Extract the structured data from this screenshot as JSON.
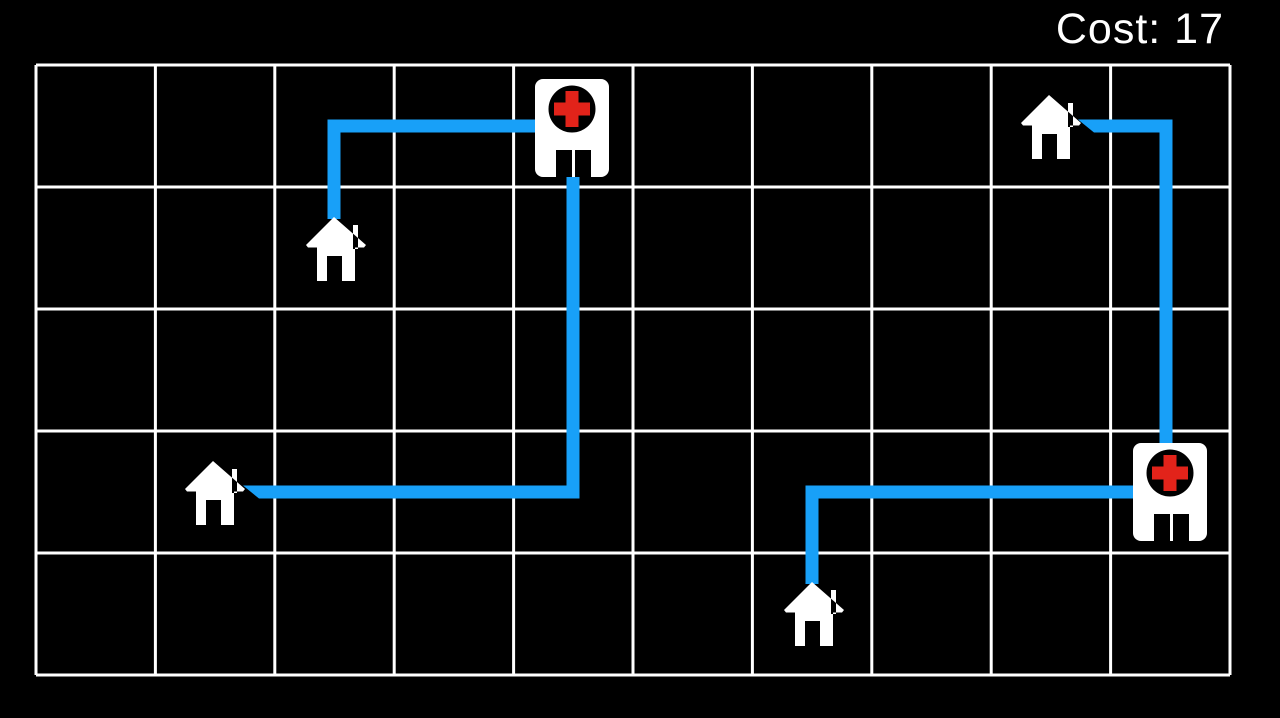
{
  "hud": {
    "cost_label": "Cost: 17",
    "cost_value": 17
  },
  "canvas": {
    "width": 1280,
    "height": 718,
    "background": "#000000"
  },
  "grid": {
    "cols": 10,
    "rows": 5,
    "x": 36,
    "y": 65,
    "width": 1194,
    "height": 610,
    "line_color": "#ffffff",
    "line_width": 3,
    "cell_background": "#000000"
  },
  "colors": {
    "route": "#18A0F8",
    "building_fill": "#ffffff",
    "medical_cross": "#E2231A",
    "icon_dark": "#000000",
    "hud_text": "#ffffff"
  },
  "style": {
    "route_width": 13
  },
  "houses": [
    {
      "id": "house-upper-left",
      "icon": "house-icon",
      "col": 2,
      "row": 1,
      "x": 306,
      "y": 217
    },
    {
      "id": "house-left",
      "icon": "house-icon",
      "col": 1,
      "row": 3,
      "x": 185,
      "y": 461
    },
    {
      "id": "house-upper-right",
      "icon": "house-icon",
      "col": 8,
      "row": 0,
      "x": 1021,
      "y": 95
    },
    {
      "id": "house-bottom",
      "icon": "house-icon",
      "col": 6,
      "row": 4,
      "x": 784,
      "y": 582
    }
  ],
  "hospitals": [
    {
      "id": "hospital-top",
      "icon": "hospital-icon",
      "col": 4,
      "row": 0,
      "x": 535,
      "y": 79
    },
    {
      "id": "hospital-right",
      "icon": "hospital-icon",
      "col": 9,
      "row": 3,
      "x": 1133,
      "y": 443
    }
  ],
  "routes": [
    {
      "id": "route-house-upper-left-to-hospital-top",
      "from": "house-upper-left",
      "to": "hospital-top",
      "cells": [
        [
          2,
          1
        ],
        [
          2,
          0
        ],
        [
          4,
          0
        ]
      ],
      "points": [
        [
          334,
          219
        ],
        [
          334,
          126
        ],
        [
          573,
          126
        ]
      ]
    },
    {
      "id": "route-hospital-top-to-house-left",
      "from": "hospital-top",
      "to": "house-left",
      "cells": [
        [
          4,
          0
        ],
        [
          4,
          3
        ],
        [
          1,
          3
        ]
      ],
      "points": [
        [
          573,
          152
        ],
        [
          573,
          492
        ],
        [
          259,
          492
        ]
      ],
      "tip": [
        [
          243,
          485.5
        ],
        [
          259,
          485.5
        ],
        [
          259,
          498.5
        ]
      ]
    },
    {
      "id": "route-house-upper-right-to-hospital-right",
      "from": "house-upper-right",
      "to": "hospital-right",
      "cells": [
        [
          8,
          0
        ],
        [
          9,
          0
        ],
        [
          9,
          3
        ]
      ],
      "points": [
        [
          1094,
          126
        ],
        [
          1166,
          126
        ],
        [
          1166,
          468
        ]
      ],
      "tip": [
        [
          1078,
          119.5
        ],
        [
          1094,
          119.5
        ],
        [
          1094,
          132.5
        ]
      ]
    },
    {
      "id": "route-house-bottom-to-hospital-right",
      "from": "house-bottom",
      "to": "hospital-right",
      "cells": [
        [
          6,
          4
        ],
        [
          6,
          3
        ],
        [
          9,
          3
        ]
      ],
      "points": [
        [
          812,
          584
        ],
        [
          812,
          492
        ],
        [
          1146,
          492
        ]
      ]
    }
  ]
}
